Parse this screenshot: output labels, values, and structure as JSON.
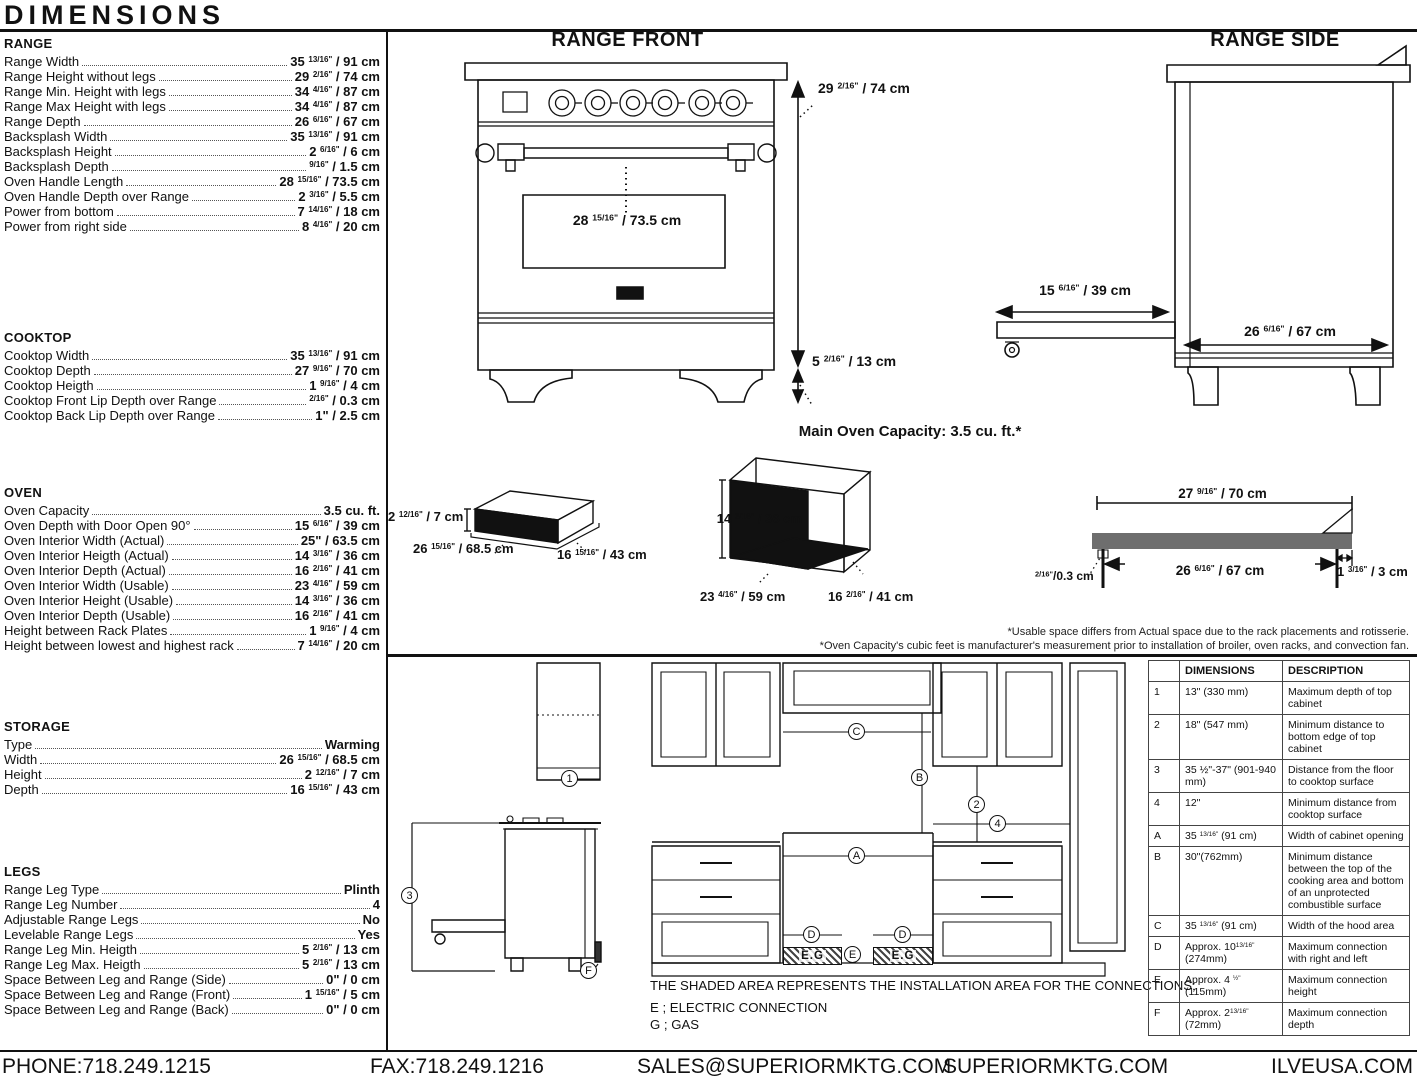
{
  "page": {
    "title": "DIMENSIONS"
  },
  "specs": [
    {
      "heading": "RANGE",
      "rows": [
        {
          "label": "Range Width",
          "value": "35 ^13/16\"^ / 91 cm"
        },
        {
          "label": "Range Height without legs",
          "value": "29 ^2/16\"^ / 74 cm"
        },
        {
          "label": "Range Min. Height with legs",
          "value": "34 ^4/16\"^ / 87 cm"
        },
        {
          "label": "Range Max Height with legs",
          "value": "34 ^4/16\"^ / 87 cm"
        },
        {
          "label": "Range Depth",
          "value": "26 ^6/16\"^ / 67 cm"
        },
        {
          "label": "Backsplash Width",
          "value": "35 ^13/16\"^ / 91 cm"
        },
        {
          "label": "Backsplash Height",
          "value": "2 ^6/16\"^ / 6 cm"
        },
        {
          "label": "Backsplash Depth",
          "value": "^9/16\"^ / 1.5 cm"
        },
        {
          "label": "Oven Handle Length",
          "value": "28 ^15/16\"^ / 73.5 cm"
        },
        {
          "label": "Oven Handle Depth over Range",
          "value": "2 ^3/16\"^ / 5.5 cm"
        },
        {
          "label": "Power from bottom",
          "value": "7 ^14/16\"^ / 18 cm"
        },
        {
          "label": "Power from right side",
          "value": "8 ^4/16\"^ / 20 cm"
        }
      ]
    },
    {
      "heading": "COOKTOP",
      "rows": [
        {
          "label": "Cooktop Width",
          "value": "35 ^13/16\"^ / 91 cm"
        },
        {
          "label": "Cooktop Depth",
          "value": "27 ^9/16\"^ / 70 cm"
        },
        {
          "label": "Cooktop Heigth",
          "value": "1 ^9/16\"^ / 4 cm"
        },
        {
          "label": "Cooktop Front Lip Depth over Range",
          "value": "^2/16\"^ / 0.3 cm"
        },
        {
          "label": "Cooktop Back Lip Depth over Range",
          "value": "1\" / 2.5 cm"
        }
      ]
    },
    {
      "heading": "OVEN",
      "rows": [
        {
          "label": "Oven Capacity",
          "value": "3.5 cu. ft."
        },
        {
          "label": "Oven Depth with Door Open 90°",
          "value": "15 ^6/16\"^ / 39 cm"
        },
        {
          "label": "Oven Interior Width (Actual)",
          "value": "25\" / 63.5 cm"
        },
        {
          "label": "Oven Interior Heigth (Actual)",
          "value": "14 ^3/16\"^ / 36 cm"
        },
        {
          "label": "Oven Interior Depth (Actual)",
          "value": "16 ^2/16\"^ / 41 cm"
        },
        {
          "label": "Oven Interior Width (Usable)",
          "value": "23 ^4/16\"^ / 59 cm"
        },
        {
          "label": "Oven Interior Height (Usable)",
          "value": "14 ^3/16\"^ / 36 cm"
        },
        {
          "label": "Oven Interior Depth (Usable)",
          "value": "16 ^2/16\"^ / 41 cm"
        },
        {
          "label": "Height between Rack Plates",
          "value": "1 ^9/16\"^ / 4 cm"
        },
        {
          "label": "Height between lowest and highest rack",
          "value": "7 ^14/16\"^ / 20 cm"
        }
      ]
    },
    {
      "heading": "STORAGE",
      "rows": [
        {
          "label": "Type",
          "value": "Warming"
        },
        {
          "label": "Width",
          "value": "26 ^15/16\"^ / 68.5 cm"
        },
        {
          "label": "Height",
          "value": "2 ^12/16\"^ / 7 cm"
        },
        {
          "label": "Depth",
          "value": "16 ^15/16\"^ / 43 cm"
        }
      ]
    },
    {
      "heading": "LEGS",
      "rows": [
        {
          "label": "Range Leg Type",
          "value": "Plinth"
        },
        {
          "label": "Range Leg Number",
          "value": "4"
        },
        {
          "label": "Adjustable Range Legs",
          "value": "No"
        },
        {
          "label": "Levelable Range Legs",
          "value": "Yes"
        },
        {
          "label": "Range Leg Min. Heigth",
          "value": "5 ^2/16\"^ / 13 cm"
        },
        {
          "label": "Range Leg Max. Heigth",
          "value": "5 ^2/16\"^ / 13 cm"
        },
        {
          "label": "Space Between Leg and Range (Side)",
          "value": "0\" / 0 cm"
        },
        {
          "label": "Space Between Leg and Range (Front)",
          "value": "1 ^15/16\"^ / 5 cm"
        },
        {
          "label": "Space Between Leg and Range (Back)",
          "value": "0\" / 0 cm"
        }
      ]
    }
  ],
  "range_front": {
    "title": "RANGE FRONT",
    "height_label": "29 ^2/16\"^ / 74 cm",
    "handle_label": "28 ^15/16\"^ / 73.5 cm",
    "leg_label": "5 ^2/16\"^ / 13 cm"
  },
  "range_side": {
    "title": "RANGE SIDE",
    "drawer_label": "15 ^6/16\"^ / 39 cm",
    "depth_label": "26 ^6/16\"^ / 67 cm"
  },
  "capacity": {
    "title": "Main Oven Capacity: 3.5 cu. ft.*",
    "drawer_height": "2 ^12/16\"^ / 7 cm",
    "drawer_width": "26 ^15/16\"^ / 68.5 cm",
    "drawer_depth": "16 ^15/16\"^ / 43 cm",
    "oven_height": "14 ^3/16\"^ / 36 cm",
    "oven_width": "23 ^4/16\"^ / 59 cm",
    "oven_depth": "16 ^2/16\"^ / 41 cm",
    "cooktop_top": "27 ^9/16\"^ / 70 cm",
    "cooktop_inner": "26 ^6/16\"^ / 67 cm",
    "cooktop_lip": "^2/16\"^/0.3 cm",
    "cooktop_right": "1 ^3/16\"^ / 3 cm",
    "footnote1": "*Usable space differs from Actual space due to the rack placements and rotisserie.",
    "footnote2": "*Oven Capacity's cubic feet is manufacturer's measurement prior to installation of broiler, oven racks, and convection fan."
  },
  "installation": {
    "note": "THE SHADED AREA REPRESENTS THE INSTALLATION AREA FOR THE CONNECTIONS;",
    "legend_e": "E ; ELECTRIC CONNECTION",
    "legend_g": "G ; GAS",
    "hatch_label": "E.G",
    "callouts": {
      "n1": "1",
      "n2": "2",
      "n3": "3",
      "n4": "4",
      "A": "A",
      "B": "B",
      "C": "C",
      "D": "D",
      "E": "E",
      "F": "F"
    }
  },
  "table": {
    "col_dim": "DIMENSIONS",
    "col_desc": "DESCRIPTION",
    "rows": [
      {
        "id": "1",
        "dim": "13\" (330 mm)",
        "desc": "Maximum depth of top cabinet"
      },
      {
        "id": "2",
        "dim": "18\" (547 mm)",
        "desc": "Minimum distance to bottom edge of top cabinet"
      },
      {
        "id": "3",
        "dim": "35 ½\"-37\" (901-940 mm)",
        "desc": "Distance from the floor to cooktop surface"
      },
      {
        "id": "4",
        "dim": "12\"",
        "desc": "Minimum distance from cooktop surface"
      },
      {
        "id": "A",
        "dim": "35 ^13/16\"^ (91 cm)",
        "desc": "Width of cabinet opening"
      },
      {
        "id": "B",
        "dim": "30\"(762mm)",
        "desc": "Minimum distance between the top of the cooking area and bottom of an unprotected combustible surface"
      },
      {
        "id": "C",
        "dim": "35 ^13/16\"^ (91 cm)",
        "desc": "Width of the hood area"
      },
      {
        "id": "D",
        "dim": "Approx. 10^13/16\"^ (274mm)",
        "desc": "Maximum connection with right and left"
      },
      {
        "id": "E",
        "dim": "Approx. 4 ^½\"^ (115mm)",
        "desc": "Maximum connection height"
      },
      {
        "id": "F",
        "dim": "Approx. 2^13/16\"^ (72mm)",
        "desc": "Maximum connection depth"
      }
    ]
  },
  "footer": {
    "phone": "PHONE:718.249.1215",
    "fax": "FAX:718.249.1216",
    "email": "SALES@SUPERIORMKTG.COM",
    "site": "SUPERIORMKTG.COM",
    "site2": "ILVEUSA.COM"
  }
}
